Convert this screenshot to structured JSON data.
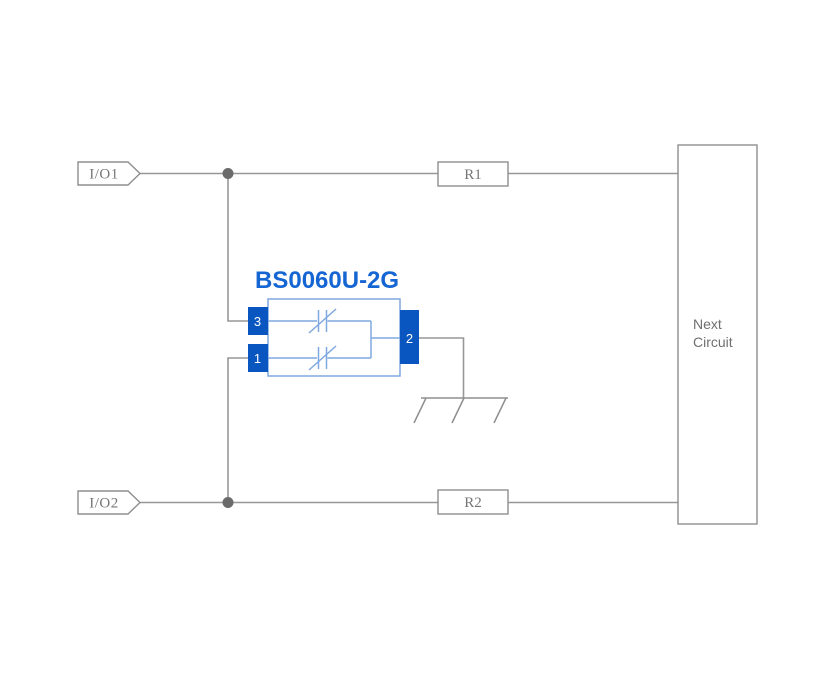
{
  "diagram": {
    "part_title": "BS0060U-2G",
    "io_tags": {
      "io1": "I/O1",
      "io2": "I/O2"
    },
    "resistors": {
      "r1": "R1",
      "r2": "R2"
    },
    "next_circuit": {
      "line1": "Next",
      "line2": "Circuit"
    },
    "pins": {
      "pin1": "1",
      "pin2": "2",
      "pin3": "3"
    },
    "icons": {
      "junction_dot": "junction-dot-icon",
      "ground": "ground-icon",
      "suppressor": "bidirectional-suppressor-icon"
    },
    "colors": {
      "background": "#ffffff",
      "wire_gray": "#979797",
      "outline_gray": "#8f8f8f",
      "junction_gray": "#6b6b6b",
      "label_gray": "#767676",
      "pin_blue": "#0a56c0",
      "component_outline_blue": "#7fa8e0",
      "title_blue": "#1565d2"
    }
  }
}
